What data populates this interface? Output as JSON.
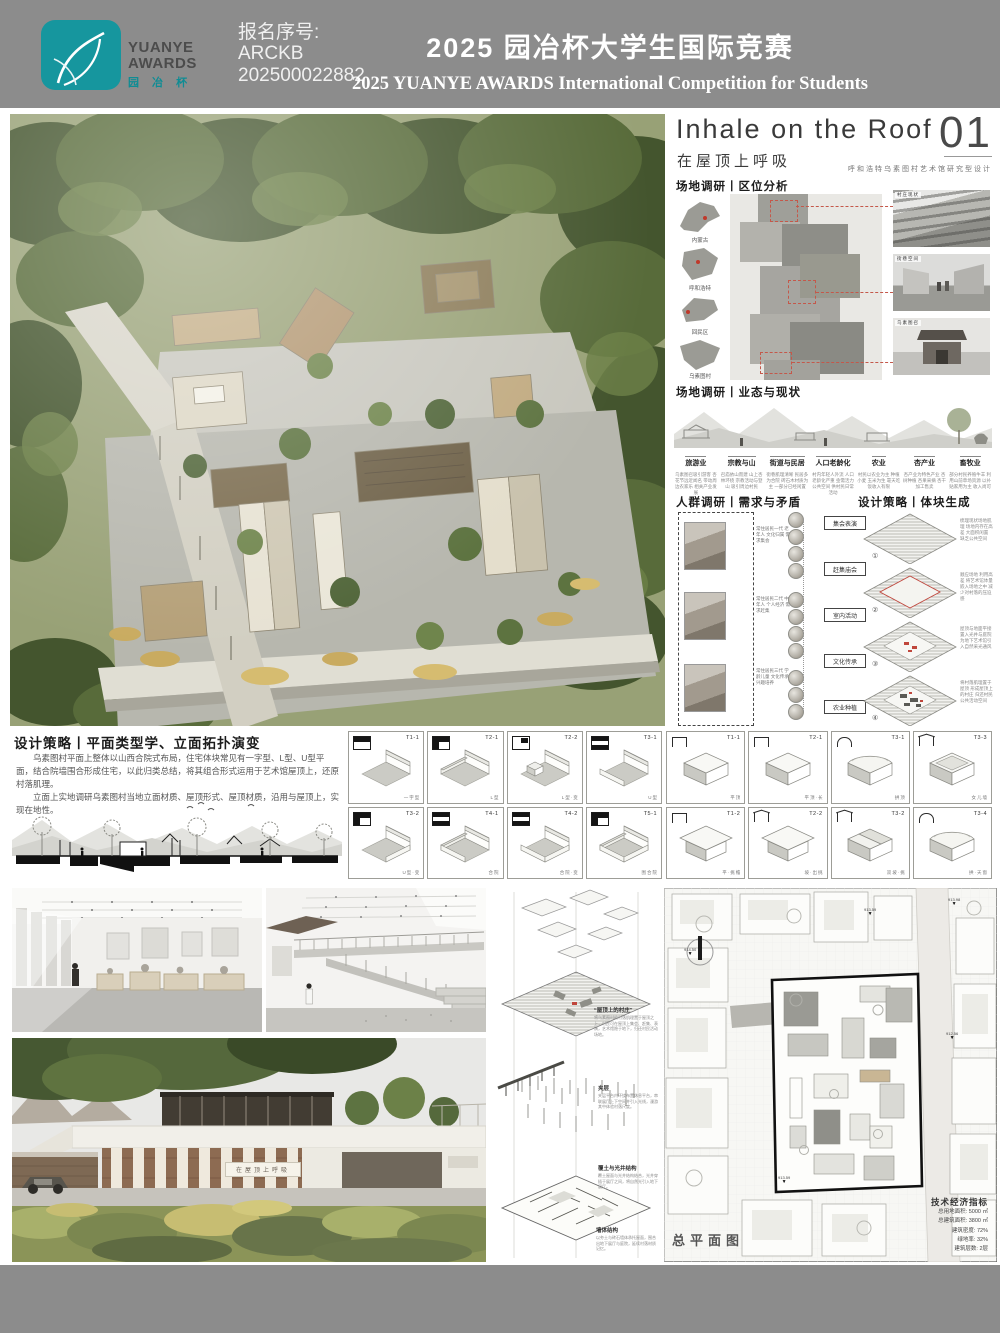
{
  "header": {
    "logo": {
      "line1": "YUANYE",
      "line2": "AWARDS",
      "cn": "园 冶 杯"
    },
    "reg_label": "报名序号:",
    "reg_line1": "ARCKB",
    "reg_line2": "202500022882",
    "title_cn": "2025 园冶杯大学生国际竞赛",
    "title_en": "2025 YUANYE AWARDS International Competition for  Students"
  },
  "panel": {
    "title_en": "Inhale on the Roof",
    "page_no": "01",
    "title_cn": "在屋顶上呼吸",
    "subtitle": "呼和浩特乌素图村艺术馆研究型设计",
    "sec_location": "场地调研丨区位分析",
    "sec_status": "场地调研丨业态与现状",
    "sec_people": "人群调研丨需求与矛盾",
    "sec_massing": "设计策略丨体块生成",
    "maps": [
      {
        "label": "内蒙古"
      },
      {
        "label": "呼和浩特"
      },
      {
        "label": "回民区"
      },
      {
        "label": "乌素图村"
      }
    ],
    "photos": [
      {
        "label": "村庄现状"
      },
      {
        "label": "街巷空间"
      },
      {
        "label": "乌素图召"
      }
    ],
    "industries": [
      {
        "name": "旅游业",
        "desc": "乌素图召吸引游客 杏花节远近闻名 带动周边农家乐 相关产业发展"
      },
      {
        "name": "宗教与山",
        "desc": "召庙依山而建 山上杏林环绕 宗教活动与登山 吸引周边村民"
      },
      {
        "name": "街道与民居",
        "desc": "街巷肌理清晰 民居多为合院 砖石木材质为主 一部分已经闲置"
      },
      {
        "name": "人口老龄化",
        "desc": "村内年轻人外流 人口老龄化严重 亟需活力公共空间 供村民日常活动"
      },
      {
        "name": "农业",
        "desc": "村民以农业为主 种植小麦 玉米为生 靠天吃饭收入有限"
      },
      {
        "name": "杏产业",
        "desc": "杏产业为特色产业 杏树种植 杏果采摘 杏干加工售卖"
      },
      {
        "name": "畜牧业",
        "desc": "部分村民养殖牛羊 利用山前草场资源 以补贴家用为主 收入尚可"
      }
    ],
    "personas": [
      {
        "note": "常住居民一代 老年人 文化归属 需求集会"
      },
      {
        "note": "常住居民二代 中年人 个人经济 需求赶集"
      },
      {
        "note": "常住居民三代 学龄儿童 文化传承 兴趣培养"
      }
    ],
    "needs": [
      "集会表演",
      "赶集庙会",
      "室内活动",
      "文化传承",
      "农业种植"
    ],
    "massing": [
      {
        "no": "①",
        "desc": "梳理现状场地肌理 场地内存在高差 大面积闲置 缺乏公共空间"
      },
      {
        "no": "②",
        "desc": "顺应场地 利用高差 将艺术馆体量嵌入场地之中 减少对村落的压迫感"
      },
      {
        "no": "③",
        "desc": "屋顶与地面平接 置入光井与庭院 为地下艺术馆引入自然采光通风"
      },
      {
        "no": "④",
        "desc": "将村落肌理置于屋顶 形成屋顶上的村庄 归还村民公共活动空间"
      }
    ]
  },
  "strategy": {
    "heading": "设计策略丨平面类型学、立面拓扑演变",
    "para1": "乌素图村平面上整体以山西合院式布局，住宅体块常见有一字型、L型、U型平面，结合院墙围合形成住宅，以此归类总结，将其组合形式运用于艺术馆屋顶上，还原村落肌理。",
    "para2": "立面上实地调研乌素图村当地立面材质、屋顶形式、屋顶材质，沿用与屋顶上，实现在地性。",
    "plan_cells": [
      {
        "code": "T1-1",
        "cap": "一字型"
      },
      {
        "code": "T2-1",
        "cap": "L型"
      },
      {
        "code": "T2-2",
        "cap": "L型·变"
      },
      {
        "code": "T3-1",
        "cap": "U型"
      },
      {
        "code": "T3-2",
        "cap": "U型·变"
      },
      {
        "code": "T4-1",
        "cap": "合院"
      },
      {
        "code": "T4-2",
        "cap": "合院·变"
      },
      {
        "code": "T5-1",
        "cap": "围合院"
      }
    ],
    "roof_cells": [
      {
        "code": "T1-1",
        "cap": "平顶"
      },
      {
        "code": "T2-1",
        "cap": "平顶·长"
      },
      {
        "code": "T3-1",
        "cap": "拱顶"
      },
      {
        "code": "T3-3",
        "cap": "女儿墙"
      },
      {
        "code": "T1-2",
        "cap": "平·挑檐"
      },
      {
        "code": "T2-2",
        "cap": "坡·出挑"
      },
      {
        "code": "T3-2",
        "cap": "双坡·挑"
      },
      {
        "code": "T3-4",
        "cap": "拱·天窗"
      }
    ]
  },
  "bottom": {
    "axo_quote": "“屋顶上的村庄”",
    "axo_quote_desc": "将乌素图村的村落肌理置于屋顶之上，村民可在屋顶上集会、赶集、表演，艺术馆隐于地下，归还村民活动场地。",
    "axo_label_mid": "夹层",
    "axo_label_mid_desc": "夹层平台内环绕布置休息平台，串联展厅上下空间并引入光线，漫游其中体验村落尺度。",
    "axo_label_light": "覆土与光井结构",
    "axo_label_light_desc": "覆土屋面与光井结构结合，光井穿插于展厅之间，将自然光引入地下展厅。",
    "axo_label_wall": "墙体结构",
    "axo_label_wall_desc": "以夯土与砖石墙体承托屋面，围合出地下展厅与庭院，延续村落材质记忆。",
    "facade_sign": "在屋顶上呼吸",
    "plan_label": "总平面图",
    "ind_title": "技术经济指标",
    "indicators": [
      {
        "k": "总用地面积:",
        "v": "5000 ㎡"
      },
      {
        "k": "总建筑面积:",
        "v": "3800 ㎡"
      },
      {
        "k": "建筑密度:",
        "v": "72%"
      },
      {
        "k": "绿地率:",
        "v": "32%"
      },
      {
        "k": "建筑层数:",
        "v": "2层"
      }
    ],
    "spots": [
      "913.59",
      "913.98",
      "912.56",
      "914.50"
    ]
  }
}
